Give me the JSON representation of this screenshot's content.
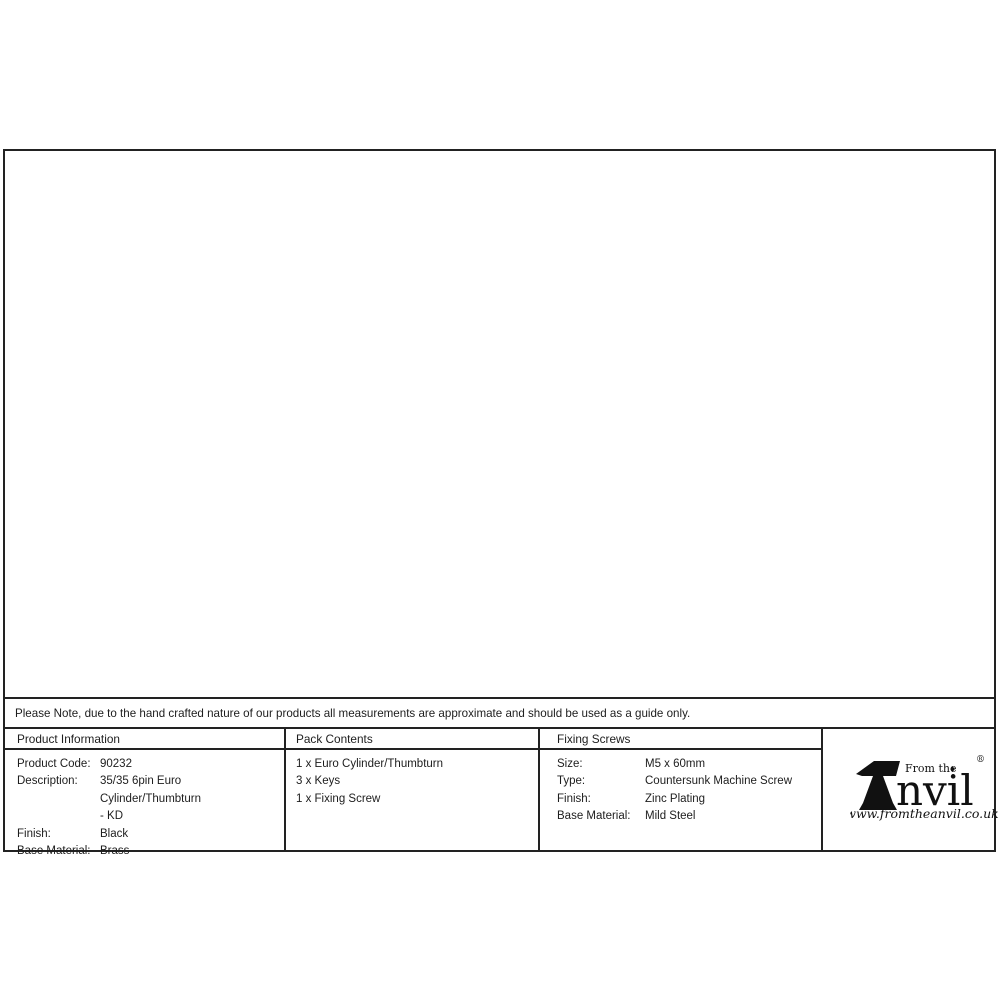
{
  "drawing": {
    "dims": {
      "cylinder_height": "32.5",
      "cylinder_length": "70",
      "thumbturn_depth": "20",
      "thumbturn_width": "15",
      "thumbturn_height": "29"
    }
  },
  "note": {
    "text": "Please Note, due to the hand crafted nature of our products all measurements are approximate and should be used as a guide only."
  },
  "table": {
    "product_information": {
      "header": "Product Information",
      "rows": [
        {
          "label": "Product Code:",
          "value": "90232"
        },
        {
          "label": "Description:",
          "value": "35/35 6pin Euro Cylinder/Thumbturn\n- KD"
        },
        {
          "label": "Finish:",
          "value": "Black"
        },
        {
          "label": "Base Material:",
          "value": "Brass"
        }
      ]
    },
    "pack_contents": {
      "header": "Pack Contents",
      "items": [
        "1 x Euro Cylinder/Thumbturn",
        "3 x Keys",
        "1 x Fixing Screw"
      ]
    },
    "fixing_screws": {
      "header": "Fixing Screws",
      "rows": [
        {
          "label": "Size:",
          "value": "M5 x 60mm"
        },
        {
          "label": "Type:",
          "value": "Countersunk Machine Screw"
        },
        {
          "label": "Finish:",
          "value": "Zinc Plating"
        },
        {
          "label": "Base Material:",
          "value": "Mild Steel"
        }
      ]
    }
  },
  "logo": {
    "tagline": "From the",
    "brand_suffix": "nvil",
    "diamond": "♦",
    "registered": "®",
    "website": "www.fromtheanvil.co.uk"
  }
}
